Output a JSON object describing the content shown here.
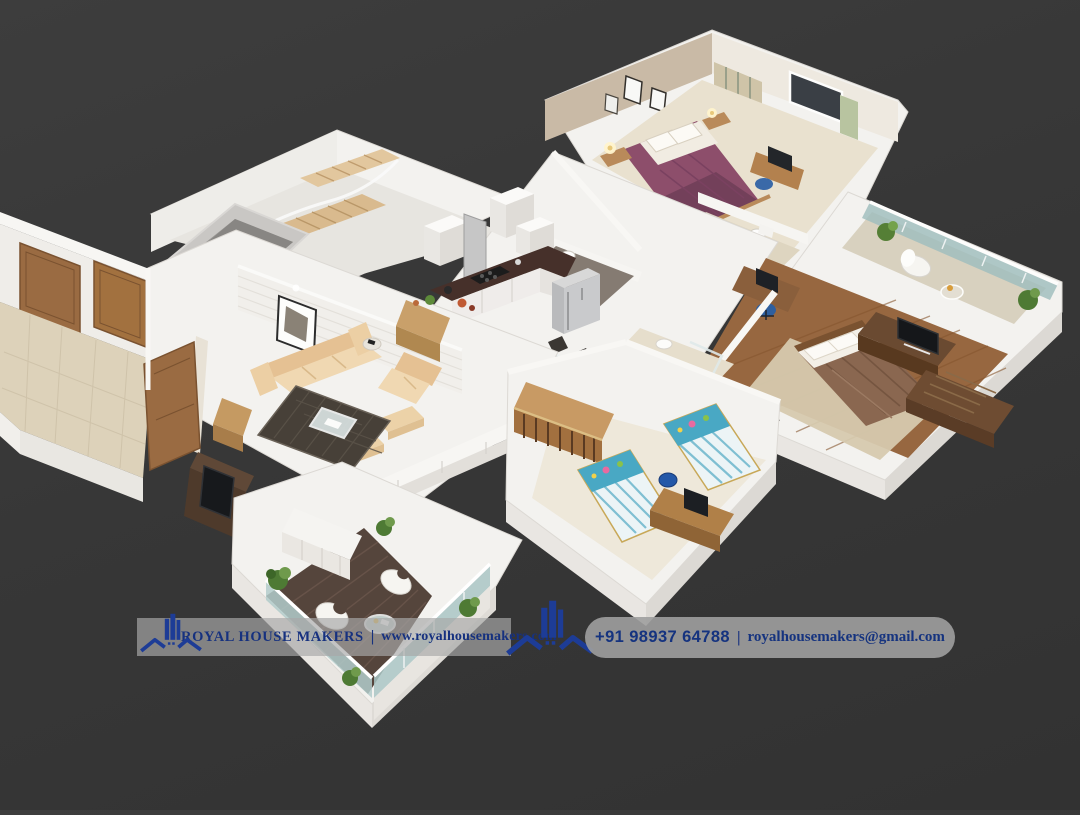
{
  "page": {
    "background_color": "#383838",
    "content_type": "3D isometric apartment floor plan render"
  },
  "scene": {
    "rooms": [
      "entrance hall with two wooden doors",
      "staircase and utility shaft",
      "living room with cream sofa set, dark rug, wall art and TV console",
      "dining area with glass table and chairs",
      "kitchen with dark counter, white cabinets and refrigerator",
      "bedroom with purple bed and attached bathroom",
      "master bedroom with brown bed, TV unit, study desk and glass balcony",
      "kids bedroom with two blue single beds, desk and wardrobe",
      "wood-deck terrace with designer chairs, round table, plants and glass railing"
    ]
  },
  "footer": {
    "left_banner": {
      "company": "ROYAL HOUSE MAKERS",
      "separator": "|",
      "website": "www.royalhousemakers.com"
    },
    "right_banner": {
      "phone": "+91 98937 64788",
      "separator": "|",
      "email": "royalhousemakers@gmail.com"
    },
    "colors": {
      "logo_blue": "#1d3c96",
      "text_navy": "#16317f",
      "banner_gray": "rgba(162,162,162,0.67)",
      "background": "#383838"
    }
  }
}
